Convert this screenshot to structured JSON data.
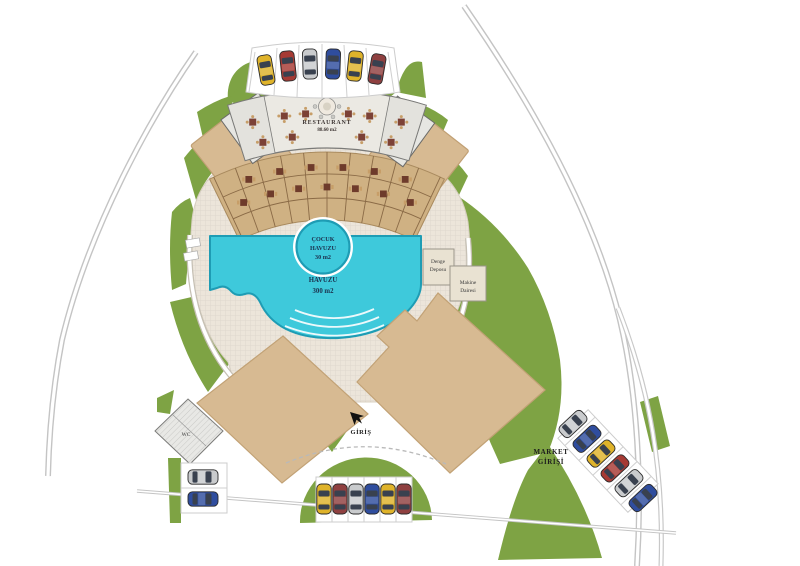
{
  "plan": {
    "restaurant": {
      "name": "RESTAURANT",
      "area": "88.60 m2"
    },
    "kids_pool": {
      "lines": [
        "ÇOCUK",
        "HAVUZU",
        "30  m2"
      ]
    },
    "main_pool": {
      "lines": [
        "YÜZME",
        "HAVUZU",
        "300  m2"
      ]
    },
    "balance_tank": {
      "lines": [
        "Denge",
        "Deposu"
      ]
    },
    "machine_room": {
      "lines": [
        "Makine",
        "Dairesi"
      ]
    },
    "entrance_label": "GİRİŞ",
    "market_entrance": {
      "lines": [
        "MARKET",
        "GİRİŞİ"
      ]
    },
    "wc_label": "WC"
  },
  "parking": {
    "north_cars": [
      "yellow",
      "red",
      "silver",
      "blue",
      "yellow",
      "dark-red"
    ],
    "south_cars": [
      "yellow",
      "dark-red",
      "silver",
      "blue",
      "yellow",
      "dark-red"
    ],
    "east_cars": [
      "silver",
      "blue",
      "yellow",
      "red",
      "silver",
      "blue"
    ],
    "west_cars": [
      "silver",
      "blue"
    ]
  },
  "colors": {
    "green": "#7ea344",
    "deck": "#ece5da",
    "pool": "#3ec9db",
    "pool_edge": "#1e9cb4",
    "building_tan": "#d7ba92",
    "terrace_wood": "#cfb183",
    "road": "#c2c2c2",
    "car_yellow": "#dfb32a",
    "car_red": "#a63a34",
    "car_silver": "#c9cbcd",
    "car_blue": "#2f4d9e",
    "car_darkred": "#8f4040"
  }
}
